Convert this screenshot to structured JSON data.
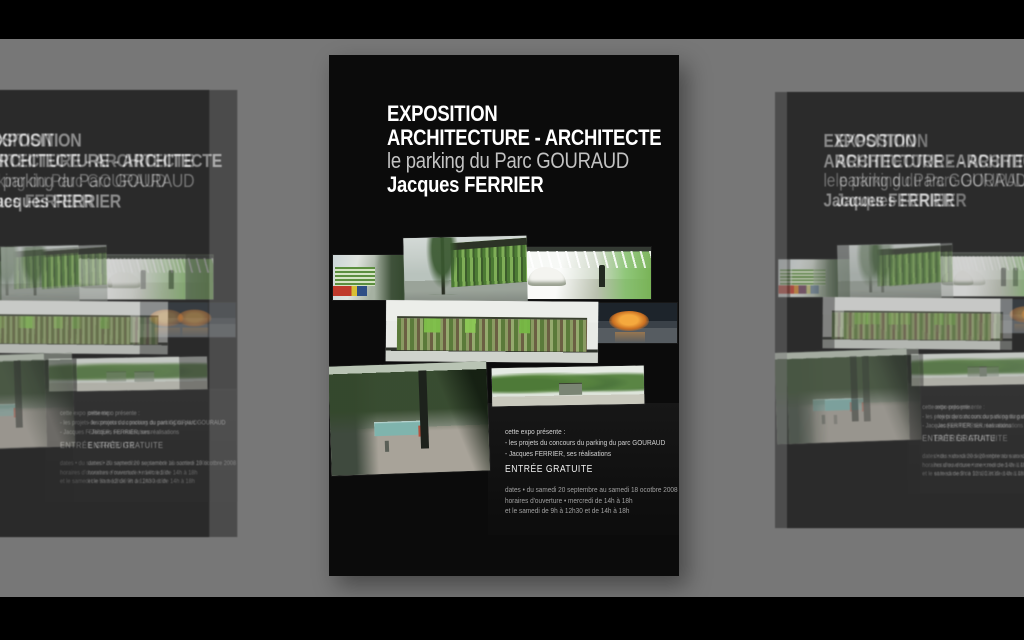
{
  "scene": {
    "background_color": "#777777",
    "letterbox_color": "#000000"
  },
  "poster": {
    "background_color": "#0b0b0b",
    "accent_green": "#7fc04a",
    "accent_orange": "#f5a93e",
    "title_line1": "EXPOSITION",
    "title_line2": "ARCHITECTURE - ARCHITECTE",
    "subtitle": "le parking du Parc GOURAUD",
    "author": "Jacques FERRIER",
    "expo_intro": "cette expo présente :",
    "expo_item1": "- les projets du concours du parking du parc GOURAUD",
    "expo_item2": "- Jacques FERRIER, ses réalisations",
    "free_entry": "ENTRÉE GRATUITE",
    "dates_line1": "dates • du samedi 20 septembre au samedi 18 ocotbre 2008",
    "dates_line2": "horaires d'ouverture • mercredi de 14h à 18h",
    "dates_line3": "et le samedi de 9h à 12h30 et de 14h à 18h",
    "images": [
      "bus-street-rendering",
      "building-entrance-rendering",
      "parking-interior-rendering",
      "orange-lobby-rendering",
      "building-elevation-rendering",
      "street-scene-rendering",
      "park-panorama-rendering"
    ]
  }
}
